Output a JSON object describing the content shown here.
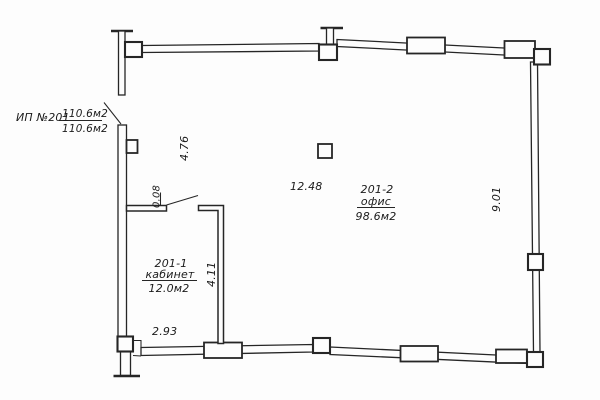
{
  "plan": {
    "unit": {
      "label": "ИП №201",
      "area_numerator": "110.6м2",
      "area_denominator": "110.6м2"
    },
    "rooms": [
      {
        "number": "201-2",
        "name": "офис",
        "area": "98.6м2"
      },
      {
        "number": "201-1",
        "name": "кабинет",
        "area": "12.0м2"
      }
    ],
    "dimensions": {
      "entry_side": "4.76",
      "partition_offset": "0.08",
      "office_width": "12.48",
      "office_depth": "9.01",
      "cabinet_depth": "4.11",
      "cabinet_width": "2.93"
    },
    "colors": {
      "ink": "#262626",
      "paper": "#fdfdfd"
    }
  }
}
